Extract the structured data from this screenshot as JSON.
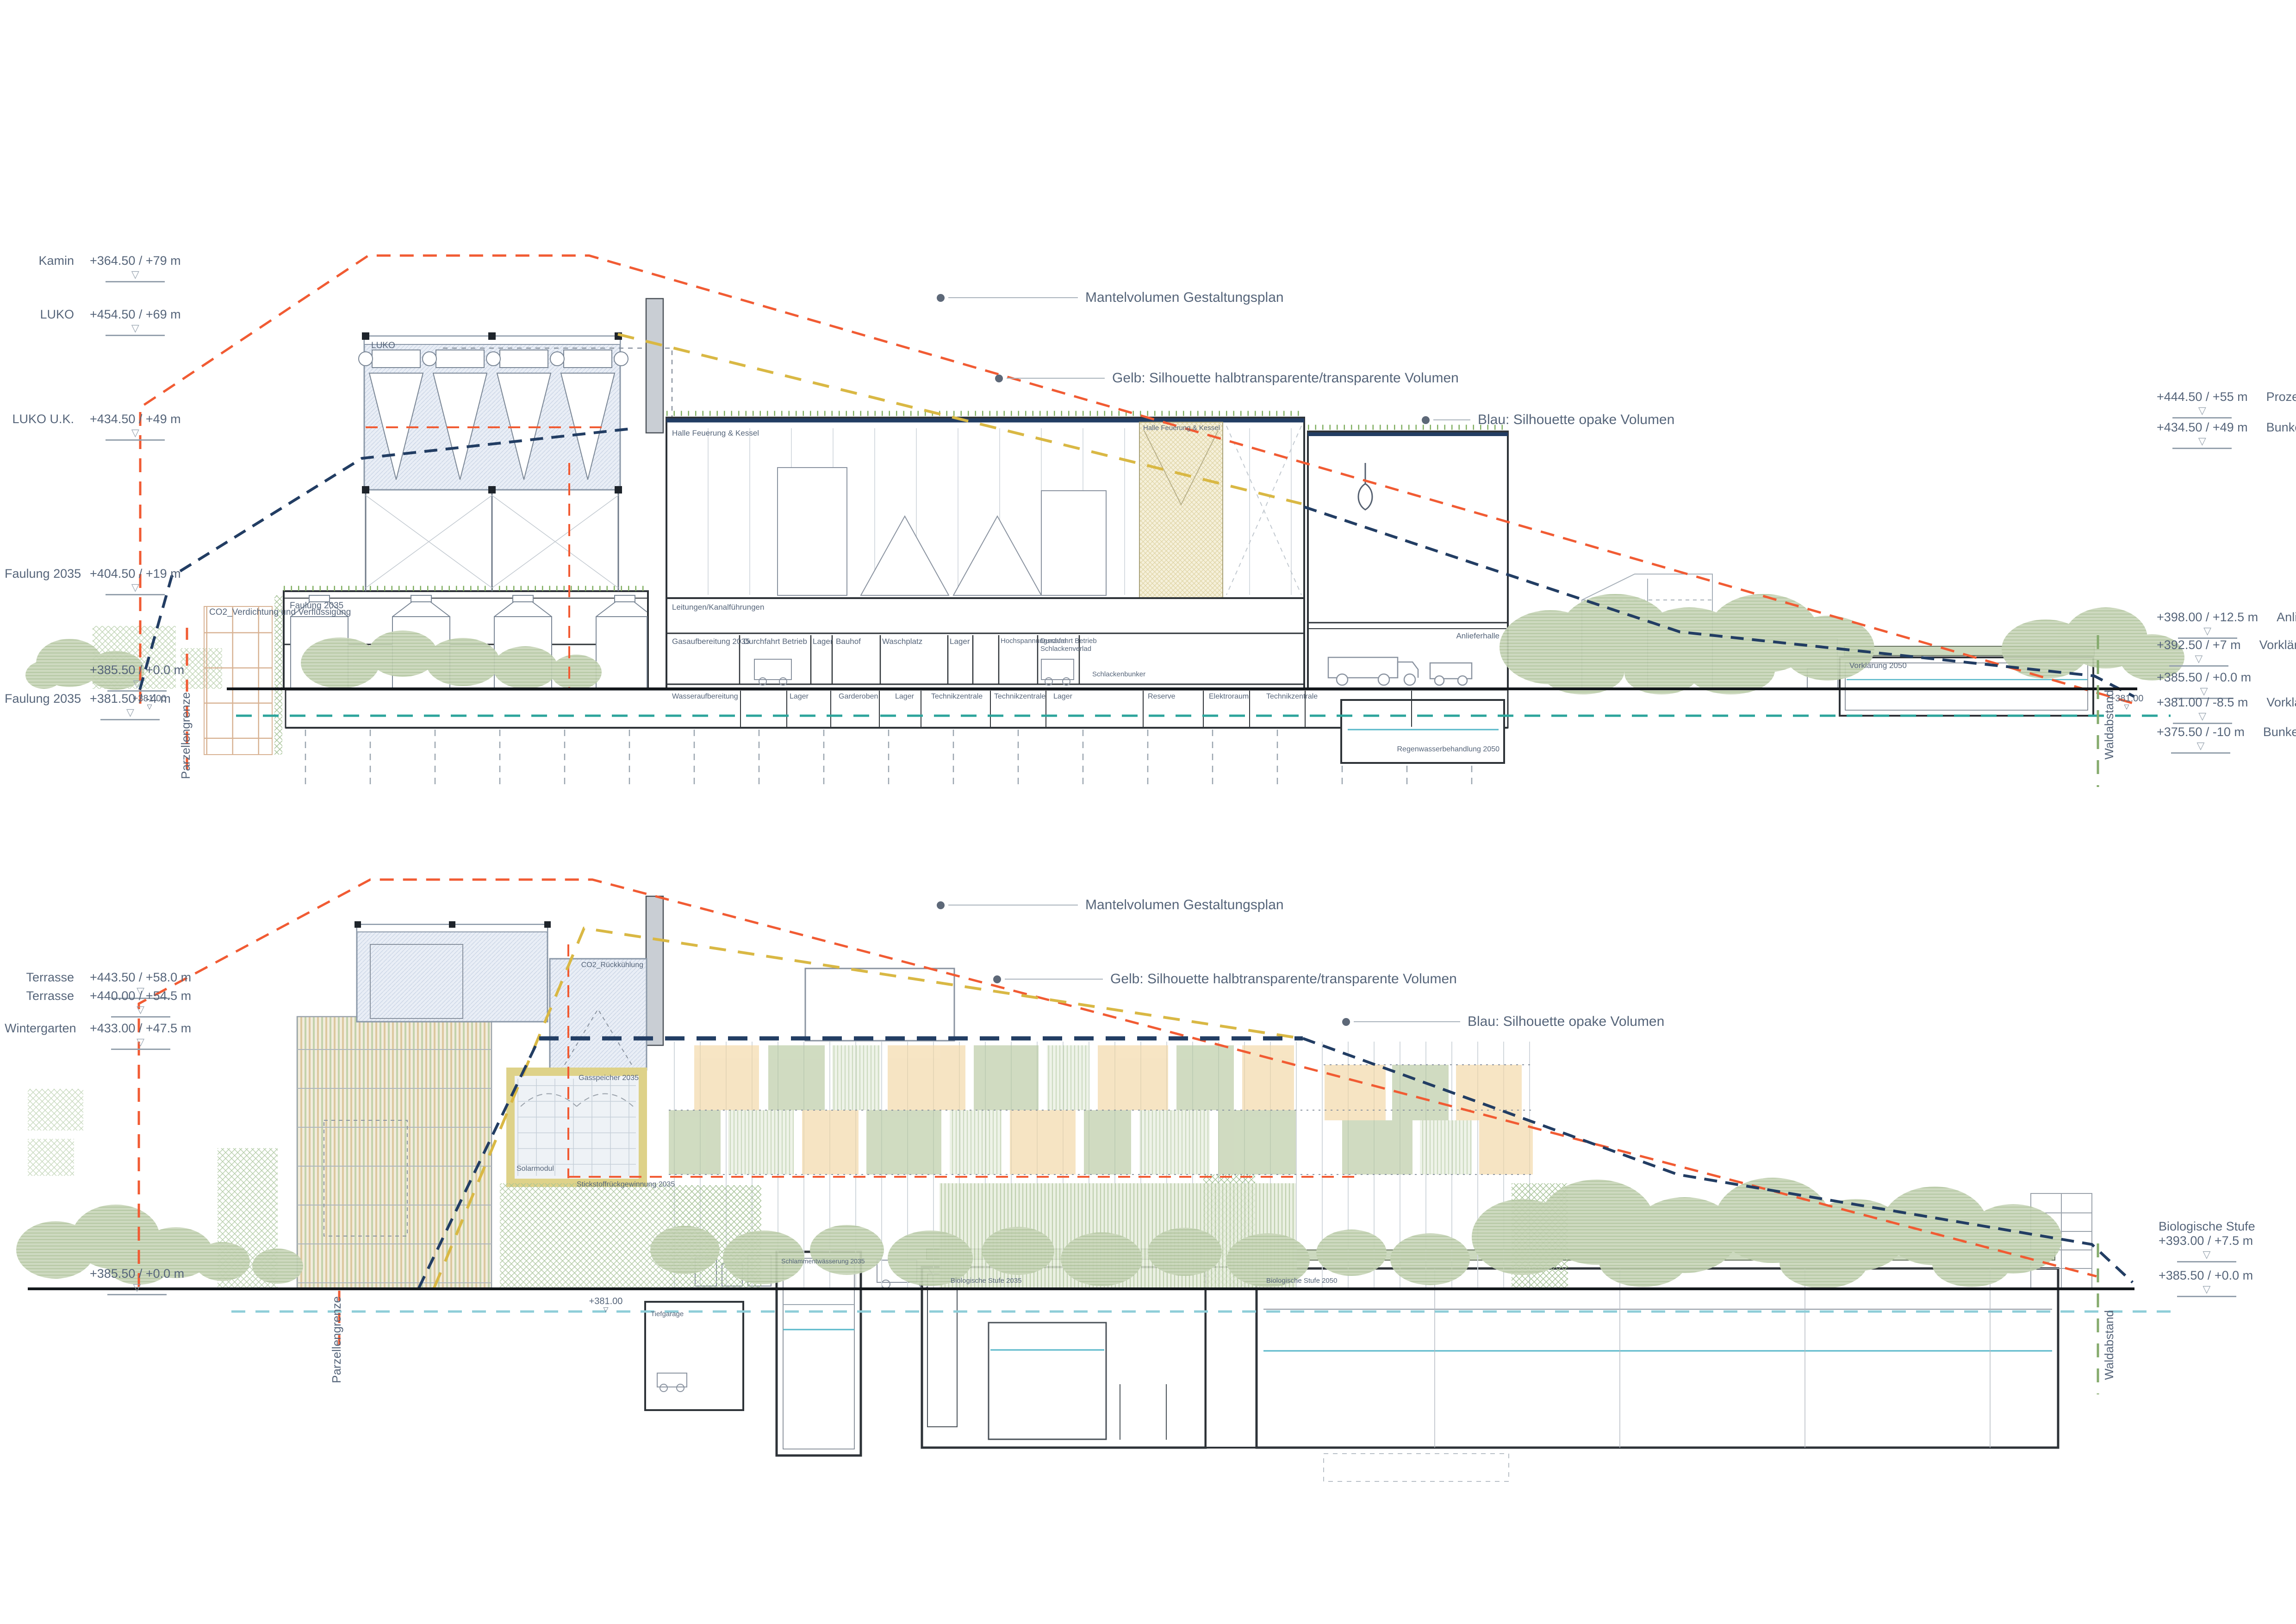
{
  "colors": {
    "envelope_red": "#f15b33",
    "silhouette_yellow": "#d9b844",
    "silhouette_blue": "#223d63",
    "groundwater_teal": "#2ca49b",
    "groundwater_teal_light": "#8ecdd8",
    "boundary_green": "#85ab6d",
    "label_gray": "#56657a",
    "tree_green": "#c9d6ba"
  },
  "legend": {
    "mantel": "Mantelvolumen Gestaltungsplan",
    "gelb": "Gelb: Silhouette halbtransparente/transparente Volumen",
    "blau": "Blau: Silhouette opake Volumen"
  },
  "groundwater_marker": "+381.00",
  "top": {
    "levels_left": [
      {
        "name": "Kamin",
        "value": "+364.50 / +79 m"
      },
      {
        "name": "LUKO",
        "value": "+454.50 / +69 m"
      },
      {
        "name": "LUKO U.K.",
        "value": "+434.50 / +49 m"
      },
      {
        "name": "Faulung 2035",
        "value": "+404.50 / +19 m"
      },
      {
        "name": "",
        "value": "+385.50 / +0.0 m"
      },
      {
        "name": "Faulung 2035",
        "value": "+381.50 / -4 m"
      }
    ],
    "levels_right": [
      {
        "value": "+444.50 / +55 m",
        "name": "Prozessgebäude"
      },
      {
        "value": "+434.50 / +49 m",
        "name": "Bunkergebäude"
      },
      {
        "value": "+398.00 / +12.5 m",
        "name": "Anlieferhalle"
      },
      {
        "value": "+392.50 / +7 m",
        "name": "Vorklärung 2035"
      },
      {
        "value": "+385.50 / +0.0 m",
        "name": ""
      },
      {
        "value": "+381.00 / -8.5 m",
        "name": "Vorklärung 2035"
      },
      {
        "value": "+375.50 / -10 m",
        "name": "Bunkergebäude"
      }
    ],
    "boundary_left": "Parzellengrenze",
    "boundary_right": "Waldabstand",
    "labels": {
      "luko": "LUKO",
      "halle_feuerung": "Halle Feuerung & Kessel",
      "co2_verdichtung": "CO2_Verdichtung und Verflüssigung",
      "faulung": "Faulung 2035",
      "leitungen": "Leitungen/Kanalführungen",
      "schlackenbunker": "Schlackenbunker",
      "anlieferhalle": "Anlieferhalle",
      "regenwasser": "Regenwasserbehandlung 2050",
      "vorklaerung": "Vorklärung 2050"
    },
    "ground_rooms": [
      "Gasaufbereitung 2035",
      "Durchfahrt Betrieb",
      "Lager",
      "Bauhof",
      "Waschplatz",
      "Lager",
      "Hochspannungsraum",
      "Durchfahrt Betrieb Schlackenverlad"
    ],
    "basement_rooms": [
      "Wasseraufbereitung",
      "Lager",
      "Garderoben",
      "Lager",
      "Technikzentrale",
      "Technikzentrale",
      "Lager",
      "Reserve",
      "Elektroraum",
      "Technikzentrale"
    ]
  },
  "bottom": {
    "levels_left": [
      {
        "name": "Terrasse",
        "value": "+443.50 / +58.0 m"
      },
      {
        "name": "Terrasse",
        "value": "+440.00 / +54.5 m"
      },
      {
        "name": "Wintergarten",
        "value": "+433.00 / +47.5 m"
      },
      {
        "name": "",
        "value": "+385.50 / +0.0 m"
      }
    ],
    "levels_right": [
      {
        "name": "Biologische Stufe",
        "value": "+393.00 / +7.5 m"
      },
      {
        "name": "",
        "value": "+385.50 / +0.0 m"
      }
    ],
    "boundary_left": "Parzellengrenze",
    "boundary_right": "Waldabstand",
    "labels": {
      "co2_rueckkuehlung": "CO2_Rückkühlung",
      "gasspeicher": "Gasspeicher 2035",
      "solarmodul": "Solarmodul",
      "stickstoff": "Stickstoffrückgewinnung 2035",
      "tiefgarage": "Tiefgarage",
      "schlammentwaesserung": "Schlammentwässerung 2035",
      "bio_2035": "Biologische Stufe 2035",
      "bio_2050": "Biologische Stufe 2050"
    }
  }
}
